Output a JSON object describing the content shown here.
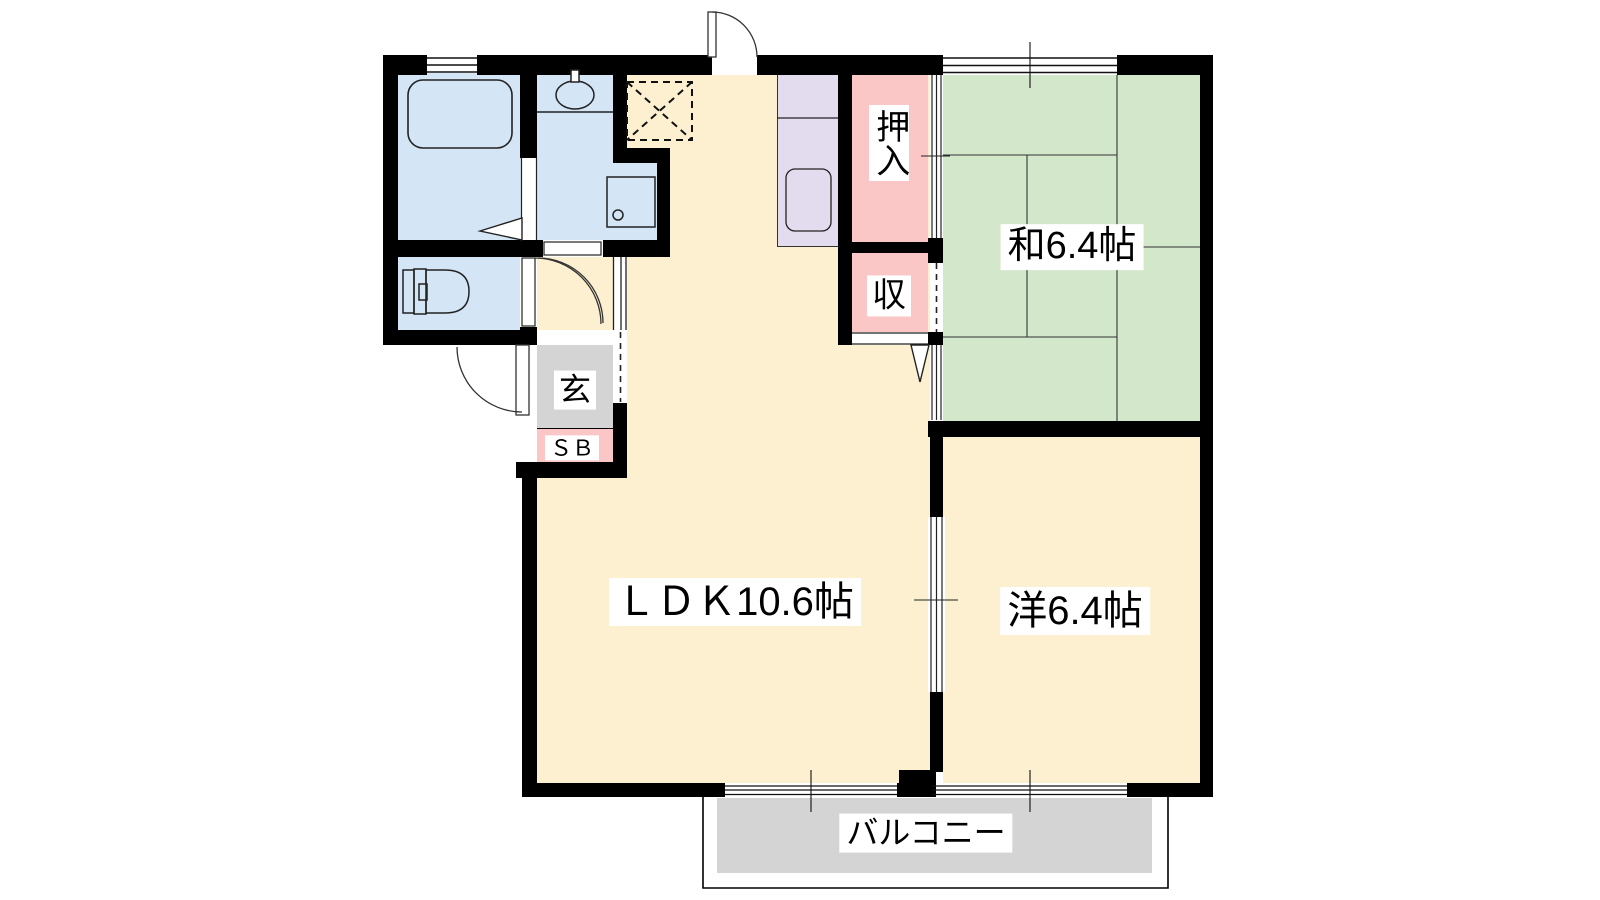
{
  "plan_title": "apartment floor plan",
  "rooms": {
    "ldk": {
      "label": "ＬＤＫ10.6帖",
      "size_tatami": "10.6",
      "color": "#FCF0D1"
    },
    "washitsu": {
      "label": "和6.4帖",
      "size_tatami": "6.4",
      "color": "#D3E7CB"
    },
    "youshitsu": {
      "label": "洋6.4帖",
      "size_tatami": "6.4",
      "color": "#FCF0D1"
    },
    "balcony": {
      "label": "バルコニー",
      "color": "#D4D4D4"
    },
    "oshiire": {
      "label": "押入",
      "color": "#FAC6C6"
    },
    "storage": {
      "label": "収",
      "color": "#FAC6C6"
    },
    "genkan": {
      "label": "玄",
      "color": "#D4D4D4"
    },
    "shoebox": {
      "label": "ＳＢ",
      "color": "#FAC6C6"
    }
  },
  "fixtures": [
    "bathtub",
    "washbasin",
    "washing-machine-space",
    "toilet",
    "kitchen-sink",
    "refrigerator-space"
  ],
  "colors": {
    "walls": "#000000",
    "wet-rooms": "#D4E5F6",
    "kitchen-counter": "#E3DCEF",
    "tatami-room": "#D3E7CB",
    "flooring": "#FCF0D1",
    "closets": "#FAC6C6",
    "entrance-balcony": "#D4D4D4"
  }
}
